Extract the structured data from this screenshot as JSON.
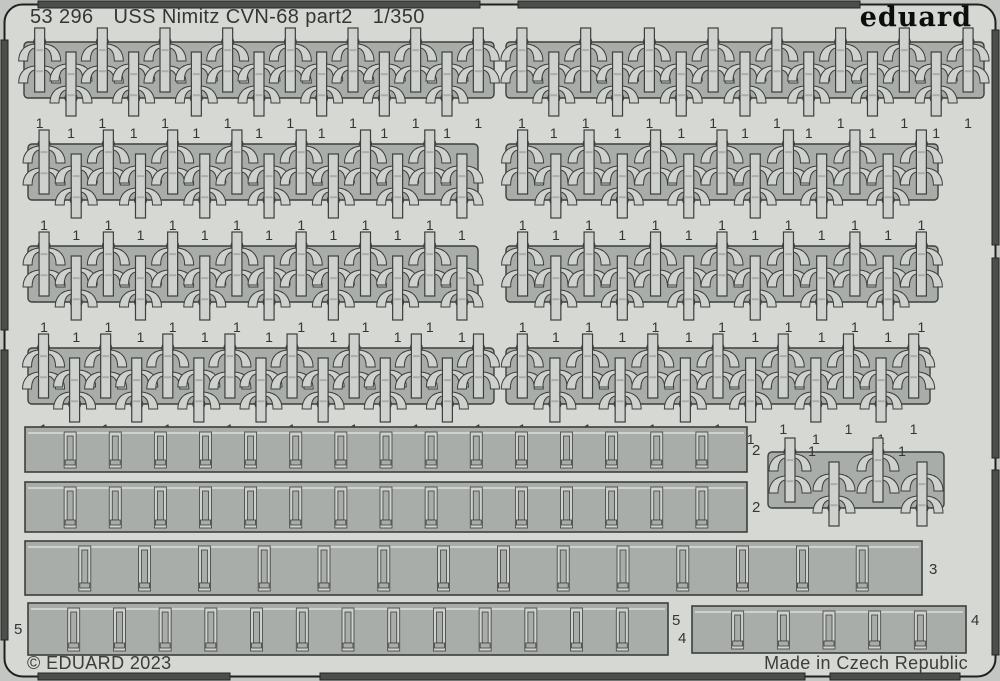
{
  "header": {
    "sheet_id": "53 296",
    "title": "USS Nimitz CVN-68 part2",
    "scale": "1/350",
    "logo": "eduard"
  },
  "footer": {
    "copyright": "© EDUARD 2023",
    "made_in": "Made in Czech Republic"
  },
  "colors": {
    "page_bg": "#c3c6c2",
    "sheet": "#d6d8d4",
    "panel": "#a9ada9",
    "slot_light": "#ced1cd",
    "outline": "#3d3f3d",
    "edge_bar": "#4c4e4c",
    "text": "#333634"
  },
  "part1_label": "1",
  "part1_blocks": [
    {
      "x": 24,
      "y": 28,
      "w": 470,
      "units": 15
    },
    {
      "x": 506,
      "y": 28,
      "w": 478,
      "units": 15
    },
    {
      "x": 28,
      "y": 130,
      "w": 450,
      "units": 14
    },
    {
      "x": 506,
      "y": 130,
      "w": 432,
      "units": 13
    },
    {
      "x": 28,
      "y": 232,
      "w": 450,
      "units": 14
    },
    {
      "x": 506,
      "y": 232,
      "w": 432,
      "units": 13
    },
    {
      "x": 28,
      "y": 334,
      "w": 466,
      "units": 15
    },
    {
      "x": 506,
      "y": 334,
      "w": 424,
      "units": 13
    }
  ],
  "cluster": {
    "x": 768,
    "y": 438,
    "w": 176,
    "units": 4,
    "labels": [
      {
        "x": 812,
        "y": 456
      },
      {
        "x": 902,
        "y": 456
      }
    ]
  },
  "strips": [
    {
      "label": "2",
      "x": 25,
      "y": 427,
      "w": 722,
      "h": 45,
      "slots": 15,
      "texts": [
        {
          "x": 752,
          "y": 455
        }
      ]
    },
    {
      "label": "2",
      "x": 25,
      "y": 482,
      "w": 722,
      "h": 50,
      "slots": 15,
      "texts": [
        {
          "x": 752,
          "y": 512
        }
      ]
    },
    {
      "label": "3",
      "x": 25,
      "y": 541,
      "w": 897,
      "h": 54,
      "slots": 14,
      "texts": [
        {
          "x": 929,
          "y": 574
        }
      ]
    },
    {
      "label": "5",
      "x": 28,
      "y": 603,
      "w": 640,
      "h": 52,
      "slots": 13,
      "texts": [
        {
          "x": 14,
          "y": 634
        },
        {
          "x": 672,
          "y": 625
        }
      ]
    },
    {
      "label": "4",
      "x": 692,
      "y": 606,
      "w": 274,
      "h": 47,
      "slots": 5,
      "texts": [
        {
          "x": 678,
          "y": 643
        },
        {
          "x": 971,
          "y": 625
        }
      ]
    }
  ],
  "frame": {
    "top_bars": [
      [
        38,
        1,
        442,
        7
      ],
      [
        518,
        1,
        342,
        7
      ]
    ],
    "bottom_bars": [
      [
        38,
        673,
        192,
        7
      ],
      [
        320,
        673,
        485,
        7
      ],
      [
        830,
        673,
        130,
        7
      ]
    ],
    "left_bars": [
      [
        1,
        40,
        7,
        290
      ],
      [
        1,
        350,
        7,
        290
      ]
    ],
    "right_bars": [
      [
        992,
        30,
        7,
        215
      ],
      [
        992,
        258,
        7,
        200
      ],
      [
        992,
        470,
        7,
        185
      ]
    ]
  }
}
